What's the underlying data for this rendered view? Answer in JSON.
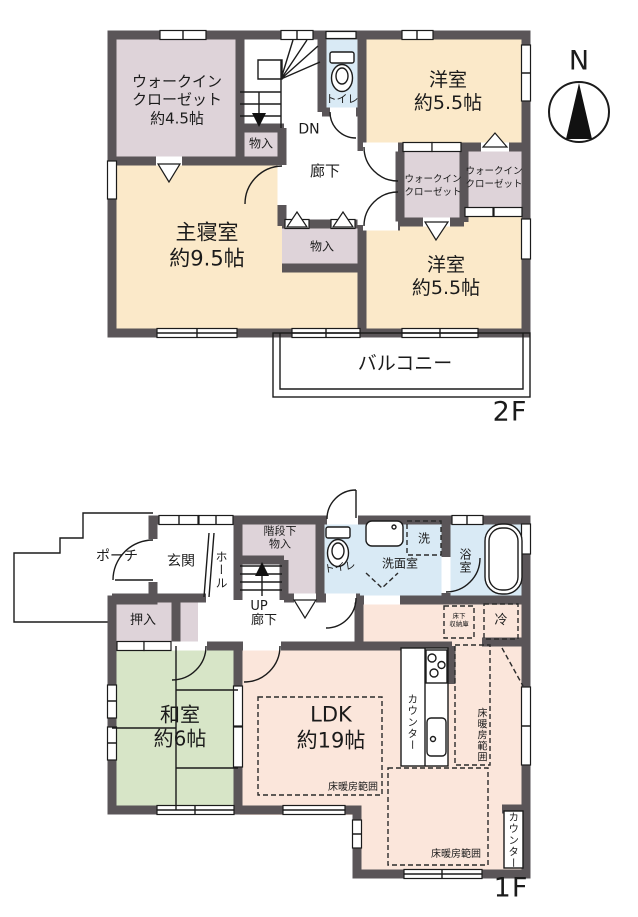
{
  "colors": {
    "wall": "#5a5558",
    "line": "#1b1b1b",
    "text": "#1b1b1b",
    "cream": "#fbe9c9",
    "mauve": "#ded3d9",
    "blue": "#d9eaf5",
    "green": "#d7e5c7",
    "pink": "#fbe6db"
  },
  "compass": {
    "north": "N"
  },
  "f2": {
    "wic45": "ウォークイン\nクローゼット\n約4.5帖",
    "storage_top": "物入",
    "toilet": "トイレ",
    "dn": "DN",
    "hallway": "廊下",
    "bedroom_ne": "洋室\n約5.5帖",
    "wic_small_left": "ウォークイン\nクローゼット",
    "wic_small_right": "ウォークイン\nクローゼット",
    "master": "主寝室\n約9.5帖",
    "storage_low": "物入",
    "bedroom_se": "洋室\n約5.5帖",
    "balcony": "バルコニー",
    "floor": "2F"
  },
  "f1": {
    "porch": "ポーチ",
    "entrance": "玄関",
    "hall": "ホール",
    "understairs": "階段下\n物入",
    "up": "UP",
    "corridor": "廊下",
    "toilet": "トイレ",
    "washer": "洗",
    "washroom": "洗面室",
    "bath": "浴室",
    "underfloor": "床下\n収納庫",
    "fridge": "冷",
    "oshiire": "押入",
    "washitsu": "和室\n約6帖",
    "ldk": "LDK\n約19帖",
    "counter_kitchen": "カウンター",
    "counter_east": "カウンター",
    "heat_ldk": "床暖房範囲",
    "heat_kitchen": "床暖房範囲",
    "heat_south": "床暖房範囲",
    "floor": "1F"
  }
}
